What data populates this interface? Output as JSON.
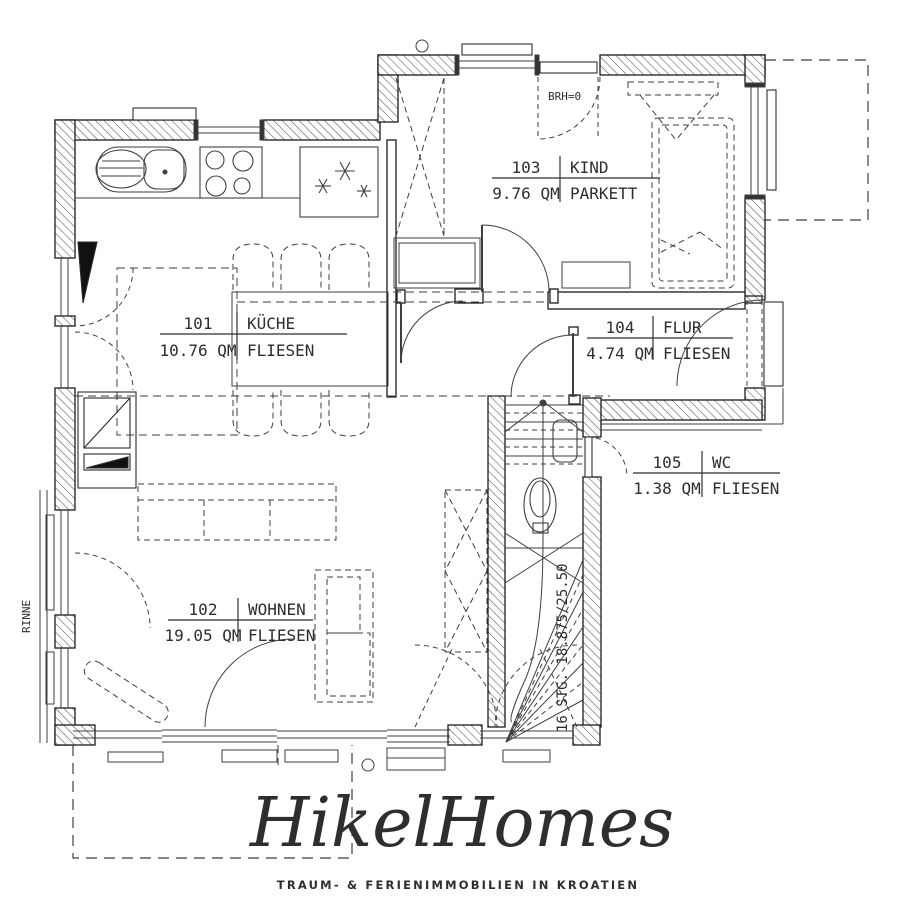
{
  "plan": {
    "rooms": [
      {
        "number": "101",
        "name": "KÜCHE",
        "area": "10.76 QM",
        "floor": "FLIESEN"
      },
      {
        "number": "102",
        "name": "WOHNEN",
        "area": "19.05 QM",
        "floor": "FLIESEN"
      },
      {
        "number": "103",
        "name": "KIND",
        "area": "9.76 QM",
        "floor": "PARKETT"
      },
      {
        "number": "104",
        "name": "FLUR",
        "area": "4.74 QM",
        "floor": "FLIESEN"
      },
      {
        "number": "105",
        "name": "WC",
        "area": "1.38 QM",
        "floor": "FLIESEN"
      }
    ],
    "annotations": {
      "sill_height": "BRH=0",
      "gutter": "RINNE",
      "stairs": "16 STG. 18.875/25.50"
    }
  },
  "logo": {
    "title": "HikelHomes",
    "tagline": "TRAUM- & FERIENIMMOBILIEN IN KROATIEN",
    "color": "#b7ca7c"
  },
  "colors": {
    "line": "#3f3f3f",
    "wall": "#1b1b1b",
    "background": "#ffffff"
  }
}
